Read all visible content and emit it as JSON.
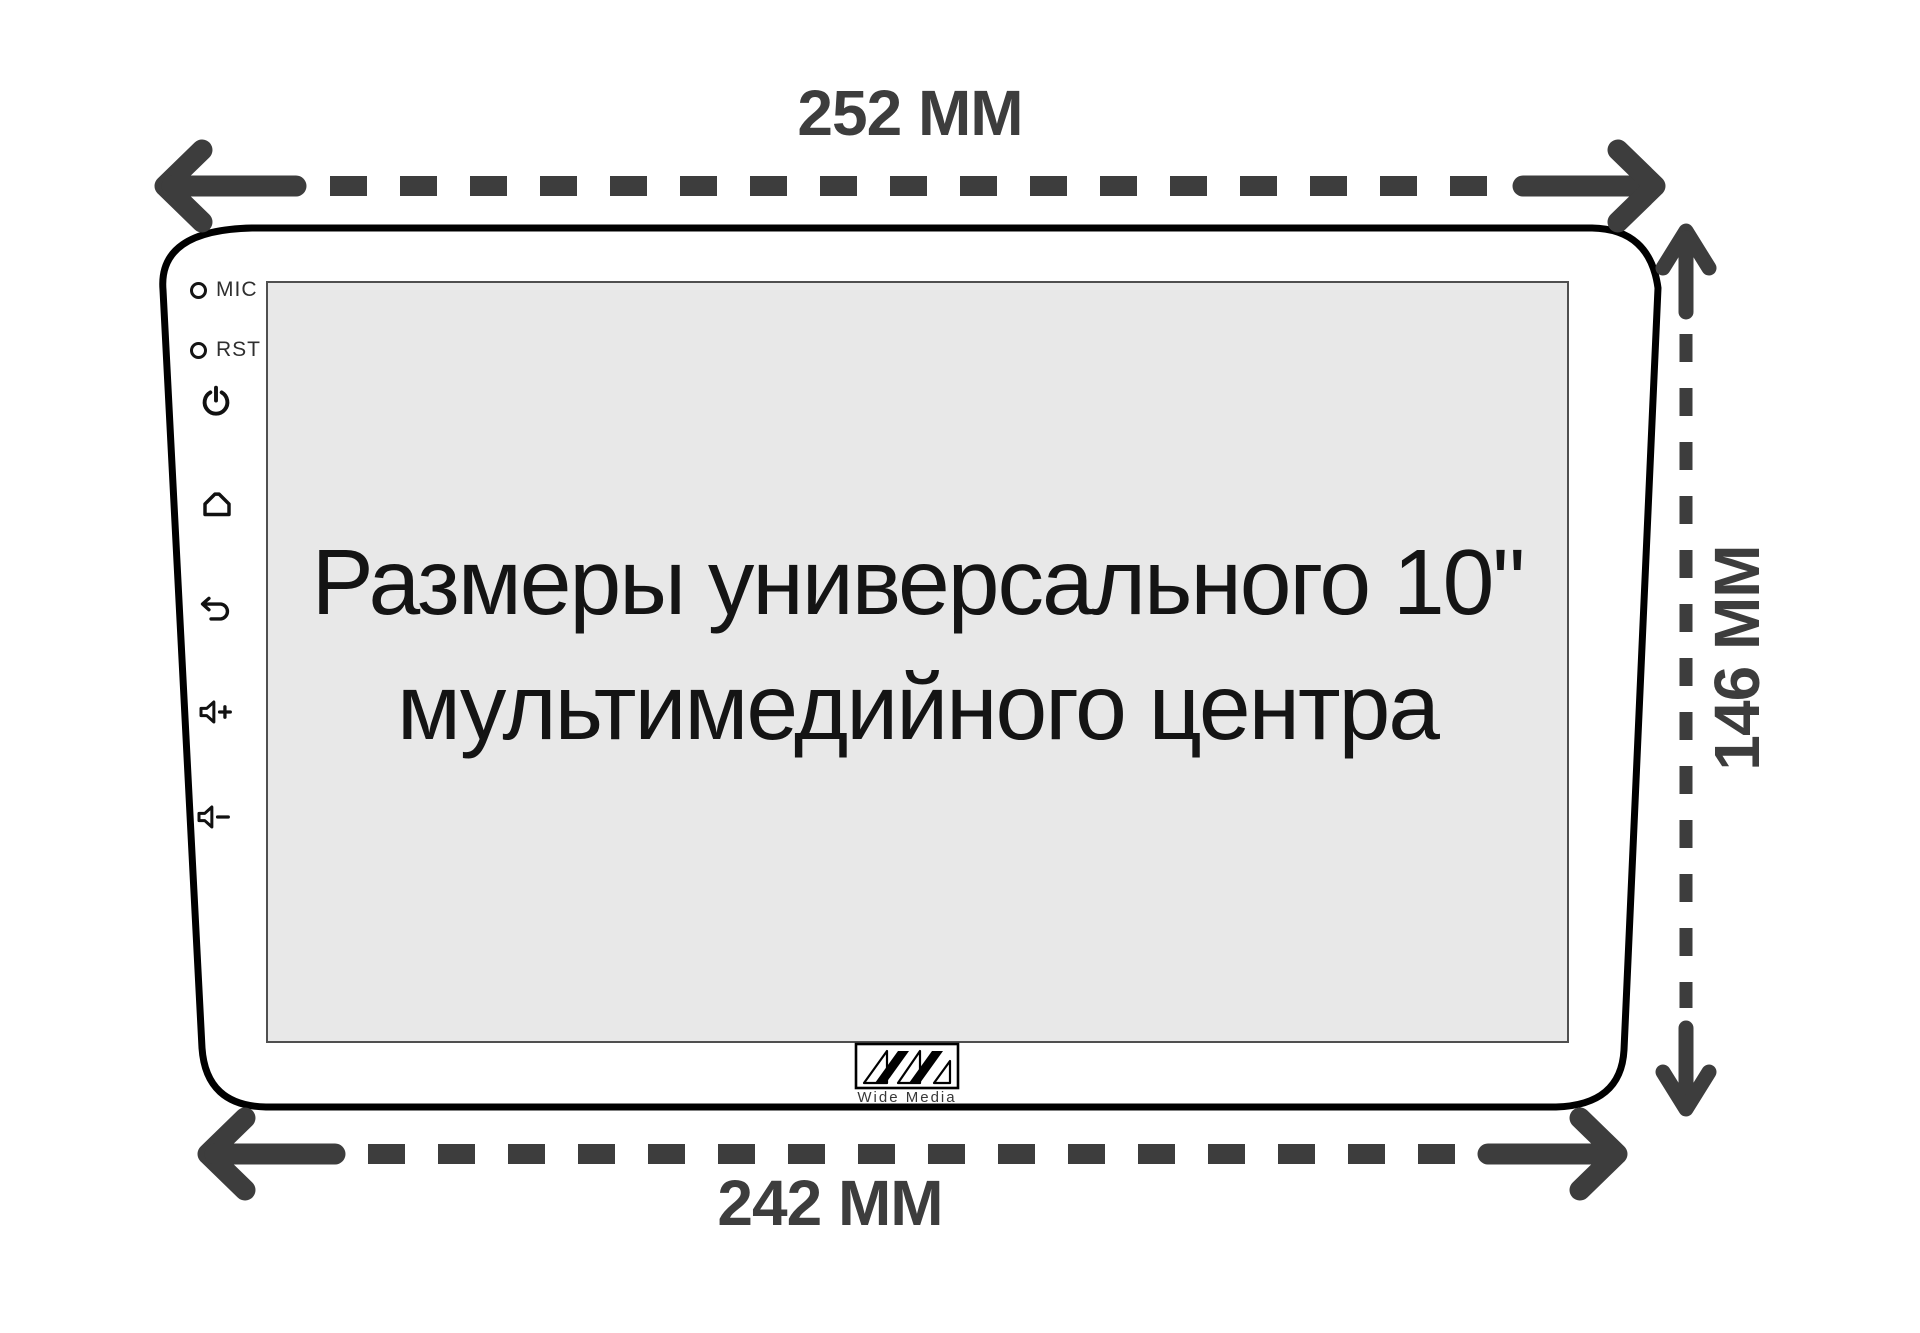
{
  "title": {
    "line1": "Размеры универсального 10\"",
    "line2": "мультимедийного центра"
  },
  "dimensions": {
    "top_width": "252 MM",
    "bottom_width": "242 MM",
    "side_height": "146 MM"
  },
  "device": {
    "controls": {
      "mic_label": "MIC",
      "rst_label": "RST",
      "icons": [
        "power-icon",
        "home-icon",
        "back-icon",
        "volume-up-icon",
        "volume-down-icon"
      ]
    },
    "logo": {
      "brand": "Wide Media"
    }
  },
  "colors": {
    "dimension_arrows": "#3d3d3d",
    "device_outline": "#000000",
    "screen_fill": "#e8e8e8"
  }
}
